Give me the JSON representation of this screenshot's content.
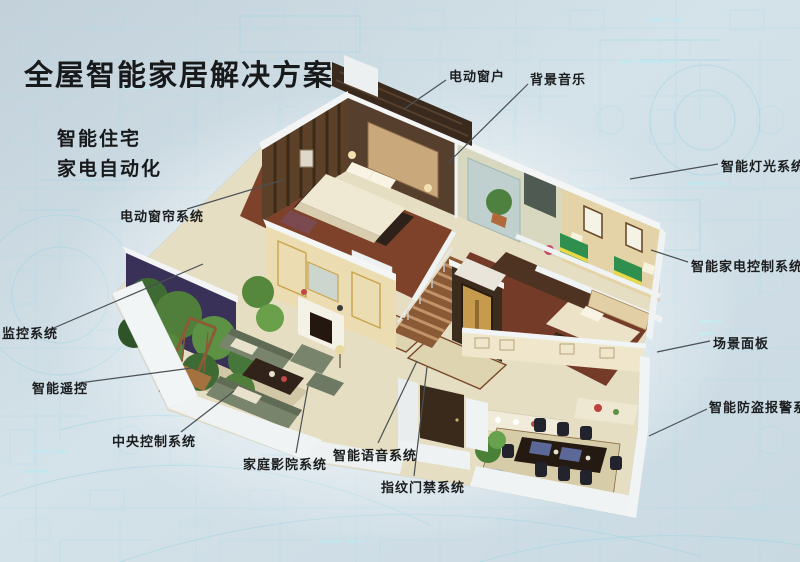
{
  "title": "全屋智能家居解决方案",
  "subtitle": {
    "line1": "智能住宅",
    "line2": "家电自动化"
  },
  "callouts": {
    "electric_window": "电动窗户",
    "background_music": "背景音乐",
    "smart_lighting": "智能灯光系统",
    "appliance_control": "智能家电控制系统",
    "scene_panel": "场景面板",
    "burglar_alarm": "智能防盗报警系统",
    "electric_curtain": "电动窗帘系统",
    "monitoring": "监控系统",
    "smart_remote": "智能遥控",
    "central_control": "中央控制系统",
    "home_theater": "家庭影院系统",
    "voice_system": "智能语音系统",
    "fingerprint_access": "指纹门禁系统"
  },
  "colors": {
    "background": "#cfdde5",
    "blueprint_line": "#9fd6e0",
    "text": "#17191b",
    "leader_line": "#4b5054"
  }
}
